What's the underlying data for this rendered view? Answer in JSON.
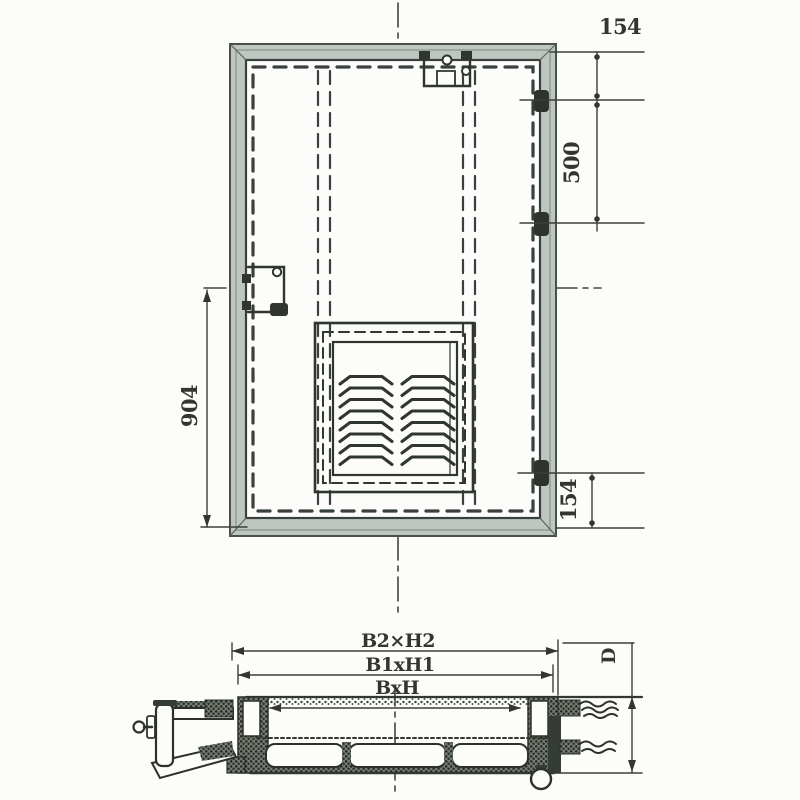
{
  "drawing": {
    "front_view": {
      "dim_top_right": "154",
      "dim_right_upper": "500",
      "dim_left": "904",
      "dim_bottom_right": "154"
    },
    "section_view": {
      "dim_outer": "B2×H2",
      "dim_middle": "B1xH1",
      "dim_inner": "BxH",
      "dim_depth": "D"
    },
    "colors": {
      "line": "#3a403c",
      "frame_fill": "#bec6c1",
      "dark_fill": "#353b36",
      "background": "#fcfcfb"
    }
  }
}
